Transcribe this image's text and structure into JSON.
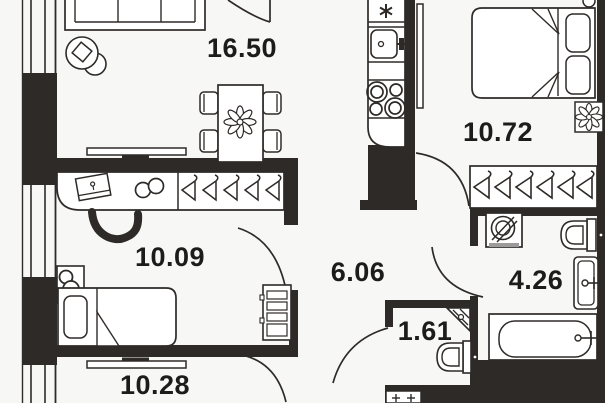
{
  "colors": {
    "background": "#f7f7f5",
    "walls": "#2e2a28",
    "lines": "#2e2a28",
    "text": "#1c1c1c",
    "appliance_base_gray": "#9b9b9b"
  },
  "rooms": {
    "living_room": {
      "area_label": "16.50"
    },
    "bedroom_large": {
      "area_label": "10.72"
    },
    "bedroom_small": {
      "area_label": "10.09"
    },
    "hallway": {
      "area_label": "6.06"
    },
    "bathroom": {
      "area_label": "4.26"
    },
    "wc": {
      "area_label": "1.61"
    },
    "room_bottom": {
      "area_label": "10.28"
    }
  }
}
